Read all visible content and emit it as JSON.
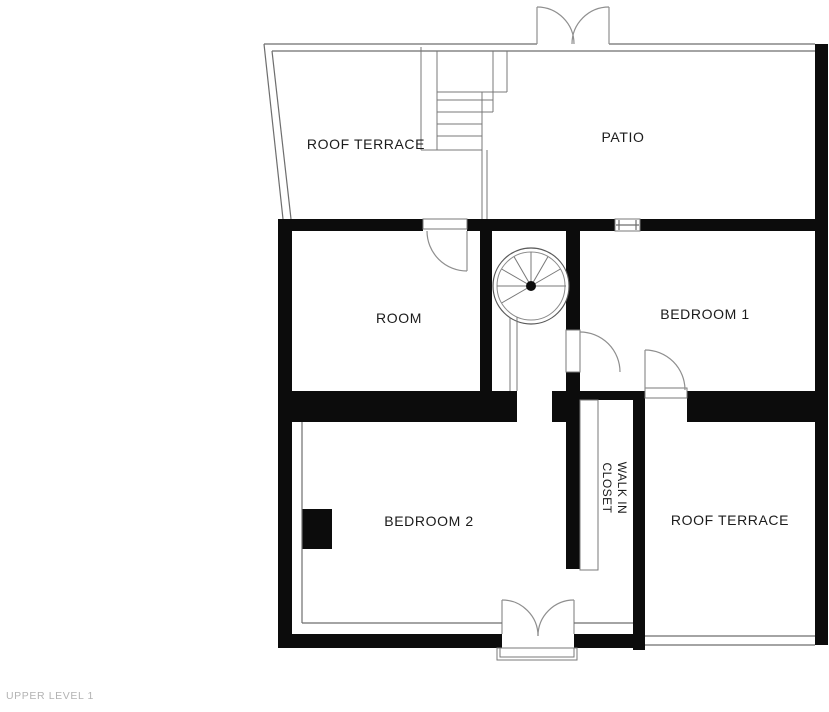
{
  "floorplan": {
    "level_label": "UPPER LEVEL 1",
    "rooms": {
      "roof_terrace_top": "ROOF TERRACE",
      "patio": "PATIO",
      "room": "ROOM",
      "bedroom_1": "BEDROOM 1",
      "bedroom_2": "BEDROOM 2",
      "walk_in_closet_line1": "WALK IN",
      "walk_in_closet_line2": "CLOSET",
      "roof_terrace_bottom": "ROOF TERRACE"
    },
    "colors": {
      "wall": "#0c0c0c",
      "line": "#6e6e6e",
      "arc": "#8f8f8f",
      "text": "#1b1b1b",
      "muted": "#b3b3b3"
    }
  }
}
